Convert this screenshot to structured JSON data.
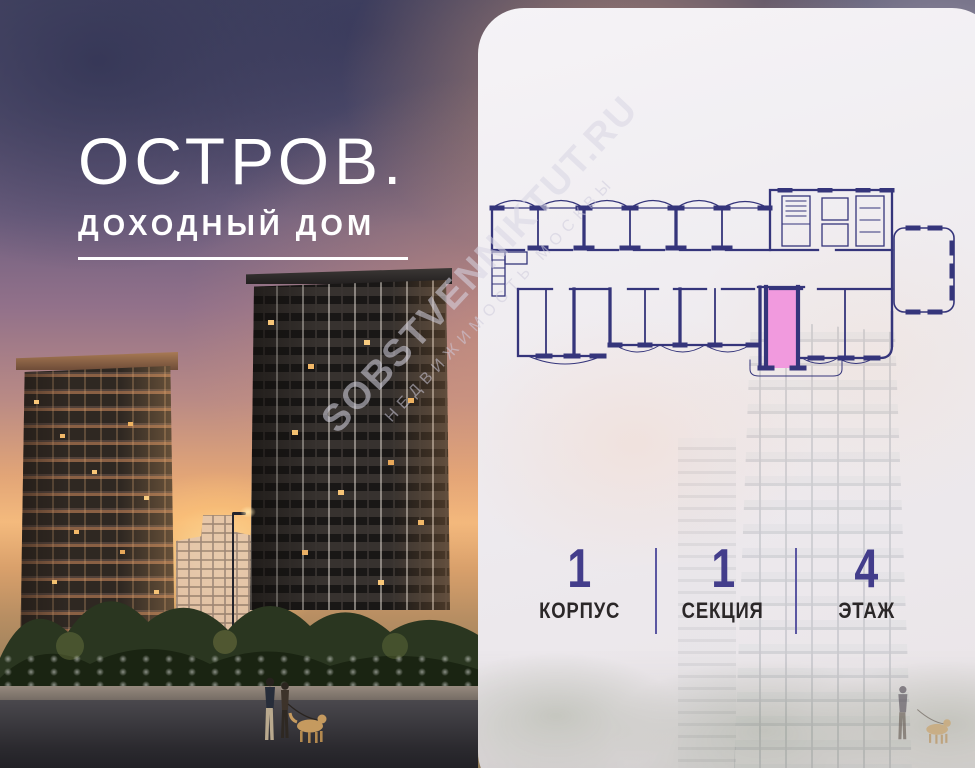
{
  "brand": {
    "title": "ОСТРОВ.",
    "subtitle": "ДОХОДНЫЙ ДОМ"
  },
  "watermark": {
    "line1": "SOBSTVENNIKTUT.RU",
    "line2": "НЕДВИЖИМОСТЬ МОСКВЫ"
  },
  "panel": {
    "stats": [
      {
        "value": "1",
        "label": "КОРПУС"
      },
      {
        "value": "1",
        "label": "СЕКЦИЯ"
      },
      {
        "value": "4",
        "label": "ЭТАЖ"
      }
    ]
  },
  "colors": {
    "unit_highlight": "#f19ade",
    "plan_line": "#35357b",
    "stat_number": "#433d8b",
    "stat_label": "#2b2728",
    "stat_divider": "#5b57a2"
  }
}
